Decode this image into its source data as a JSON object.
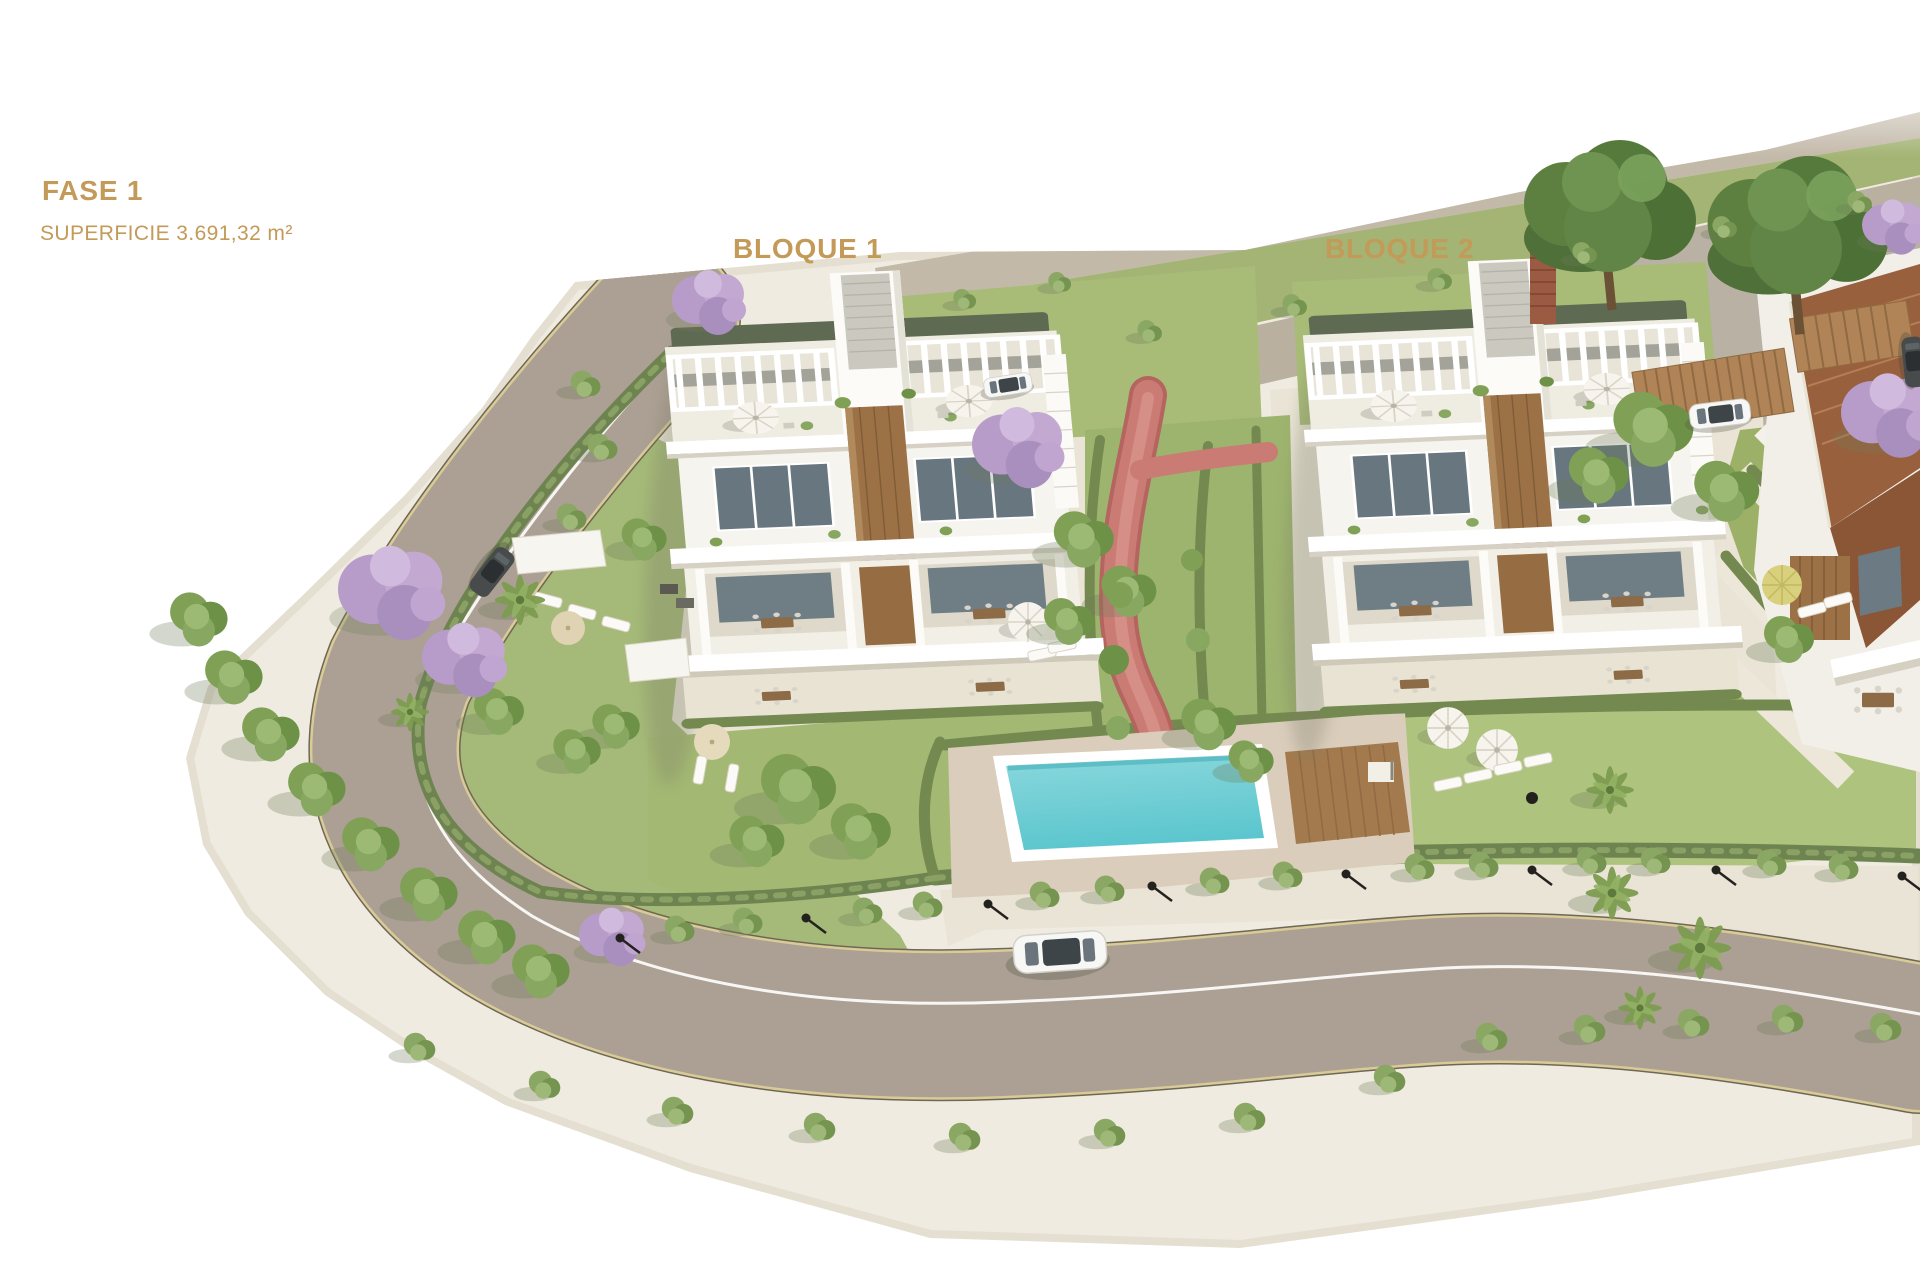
{
  "annotations": {
    "phase_label": "FASE 1",
    "surface_label": "SUPERFICIE 3.691,32 m²",
    "block1_label": "BLOQUE 1",
    "block2_label": "BLOQUE 2"
  },
  "style": {
    "label_color": "#c39a57",
    "background": "#ffffff"
  },
  "scene": {
    "type": "aerial-3d-architectural-render",
    "description": "Bird's-eye 3D rendering of phase 1 of a residential development: two white apartment blocks with roof pergolas, terraces and sun umbrellas, a communal turquoise pool with wooden deck, lawned gardens with jacaranda and palm trees, a red pedestrian path, a curving perimeter road with street trees, lamp posts and parked cars, and a partial third building with terracotta roof at the right edge",
    "colors": {
      "land": "#efebe0",
      "road": "#aba093",
      "road_edge": "#6f6755",
      "sidewalk": "#e9e4d5",
      "lawn": "#a3b873",
      "hedge": "#6d8450",
      "red_path": "#ca7b74",
      "pool_water": "#8ad8dc",
      "pool_water_deep": "#5cc6ce",
      "wood": "#9c7146",
      "terracotta_roof": "#99603e"
    }
  }
}
